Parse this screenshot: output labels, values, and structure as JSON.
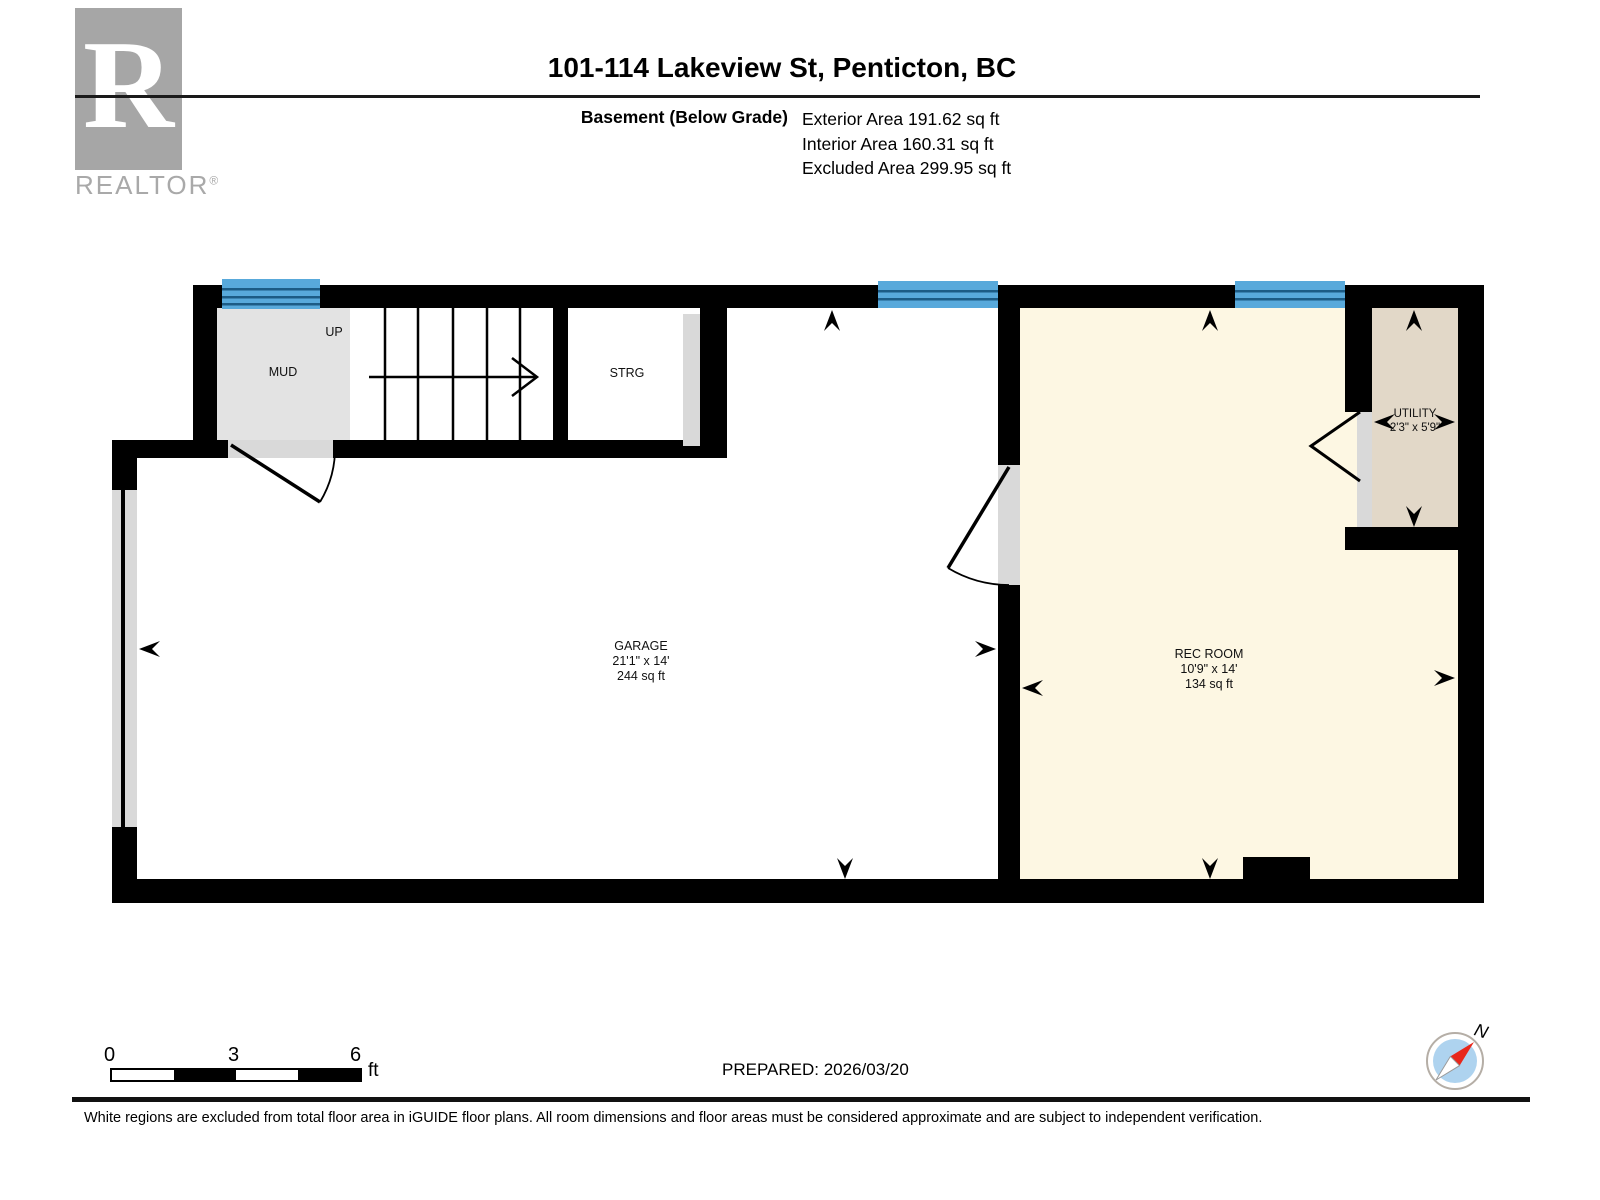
{
  "header": {
    "logo": {
      "letter": "R",
      "brand": "REALTOR",
      "registered": "®"
    },
    "title": "101-114 Lakeview St, Penticton, BC",
    "floor_label": "Basement (Below Grade)",
    "area_lines": [
      "Exterior Area 191.62 sq ft",
      "Interior Area 160.31 sq ft",
      "Excluded Area 299.95 sq ft"
    ]
  },
  "plan": {
    "rooms": {
      "mud": {
        "name": "MUD"
      },
      "stairs": {
        "direction_label": "UP"
      },
      "strg": {
        "name": "STRG"
      },
      "garage": {
        "name": "GARAGE",
        "dims": "21'1\" x 14'",
        "area": "244 sq ft"
      },
      "rec": {
        "name": "REC ROOM",
        "dims": "10'9\" x 14'",
        "area": "134 sq ft"
      },
      "utility": {
        "name": "UTILITY",
        "dims": "2'3\" x 5'9\""
      }
    },
    "colors": {
      "wall": "#000000",
      "window": "#58a9db",
      "window_line": "#1c5b85",
      "rec_fill": "#fdf7e3",
      "utility_fill": "#e2d8c8",
      "mud_fill": "#e3e3e3",
      "door_opening": "#d9d9d9"
    }
  },
  "footer": {
    "scale_bar": {
      "ticks": [
        "0",
        "3",
        "6"
      ],
      "unit": "ft"
    },
    "prepared": "PREPARED: 2026/03/20",
    "compass": {
      "north_label": "N"
    },
    "disclaimer": "White regions are excluded from total floor area in iGUIDE floor plans. All room dimensions and floor areas must be considered approximate and are subject to independent verification."
  }
}
